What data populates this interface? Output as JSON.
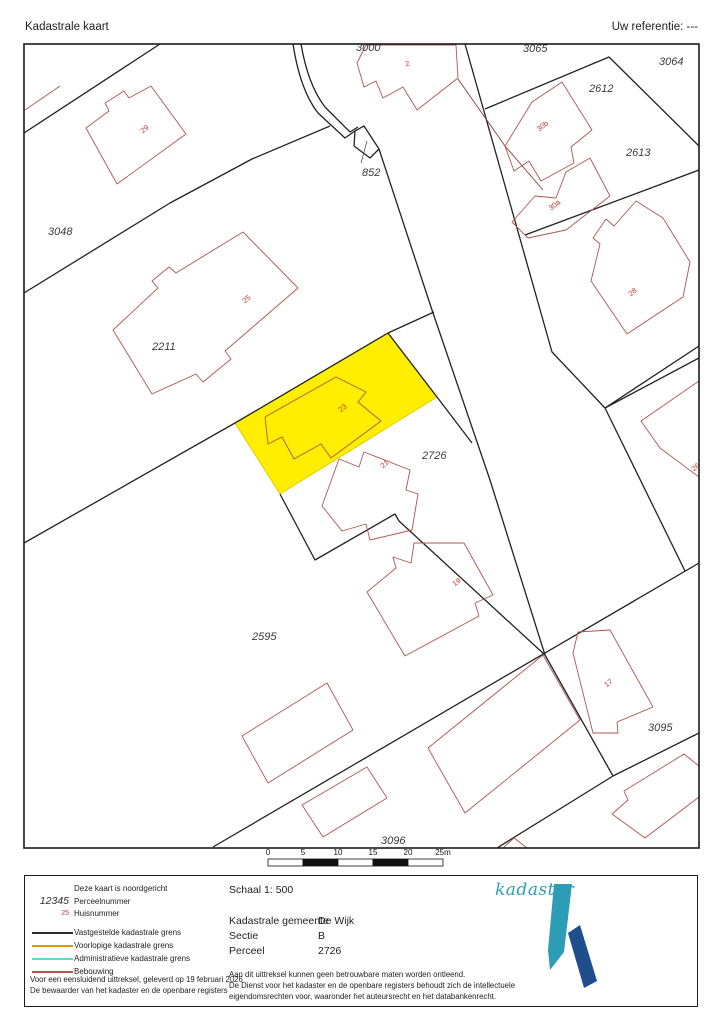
{
  "header": {
    "title": "Kadastrale kaart",
    "reference": "Uw referentie: ---"
  },
  "map": {
    "highlight_color": "#FFEE00",
    "boundary_color": "#222222",
    "building_color": "#AD5650",
    "parcel_label_color": "#3b3b3b",
    "house_number_color": "#C13B2F",
    "parcel_labels": [
      {
        "text": "3000",
        "x": 356,
        "y": 51
      },
      {
        "text": "3065",
        "x": 523,
        "y": 52
      },
      {
        "text": "3064",
        "x": 659,
        "y": 65
      },
      {
        "text": "2612",
        "x": 589,
        "y": 92
      },
      {
        "text": "2613",
        "x": 626,
        "y": 156
      },
      {
        "text": "852",
        "x": 362,
        "y": 176
      },
      {
        "text": "3048",
        "x": 48,
        "y": 235
      },
      {
        "text": "2211",
        "x": 152,
        "y": 350
      },
      {
        "text": "2726",
        "x": 422,
        "y": 459
      },
      {
        "text": "2595",
        "x": 252,
        "y": 640
      },
      {
        "text": "3095",
        "x": 648,
        "y": 731
      },
      {
        "text": "3096",
        "x": 381,
        "y": 844
      }
    ],
    "house_numbers": [
      {
        "text": "2",
        "x": 408,
        "y": 66,
        "r": -15
      },
      {
        "text": "29",
        "x": 146,
        "y": 131,
        "r": -38
      },
      {
        "text": "25",
        "x": 248,
        "y": 301,
        "r": -38
      },
      {
        "text": "30b",
        "x": 544,
        "y": 128,
        "r": -38
      },
      {
        "text": "30a",
        "x": 556,
        "y": 207,
        "r": -38
      },
      {
        "text": "28",
        "x": 634,
        "y": 294,
        "r": -38
      },
      {
        "text": "23",
        "x": 344,
        "y": 410,
        "r": -38
      },
      {
        "text": "21",
        "x": 386,
        "y": 466,
        "r": -38
      },
      {
        "text": "19",
        "x": 458,
        "y": 584,
        "r": -38
      },
      {
        "text": "17",
        "x": 610,
        "y": 685,
        "r": -38
      },
      {
        "text": "26",
        "x": 697,
        "y": 469,
        "r": -38
      }
    ]
  },
  "scalebar": {
    "ticks": [
      "0",
      "5",
      "10",
      "15",
      "20",
      "25m"
    ]
  },
  "legend": {
    "north_note": "Deze kaart is noordgericht",
    "perceel_sample": "12345",
    "perceel_label": "Perceelnummer",
    "huis_sample": "25",
    "huis_label": "Huisnummer",
    "lines": [
      {
        "label": "Vastgestelde kadastrale grens",
        "color": "#2b2b2b"
      },
      {
        "label": "Voorlopige kadastrale grens",
        "color": "#D89C00"
      },
      {
        "label": "Administratieve kadastrale grens",
        "color": "#55DFC8"
      },
      {
        "label": "Bebouwing",
        "color": "#B5534C"
      }
    ],
    "footer_line1": "Voor een eensluidend uittreksel, geleverd op 19 februari 2026",
    "footer_line2": "De bewaarder van het kadaster en de openbare registers"
  },
  "details": {
    "schaal": "Schaal 1: 500",
    "rows": [
      {
        "label": "Kadastrale gemeente",
        "value": "De Wijk"
      },
      {
        "label": "Sectie",
        "value": "B"
      },
      {
        "label": "Perceel",
        "value": "2726"
      }
    ],
    "disclaimer": [
      "Aan dit uittreksel kunnen geen betrouwbare maten worden ontleend.",
      "De Dienst voor het kadaster en de openbare registers behoudt zich de intellectuele",
      "eigendomsrechten voor, waaronder het auteursrecht en het databankenrecht."
    ]
  },
  "logo": {
    "text": "kadaster",
    "teal": "#2D9CB5",
    "blue": "#1F4E8C"
  }
}
